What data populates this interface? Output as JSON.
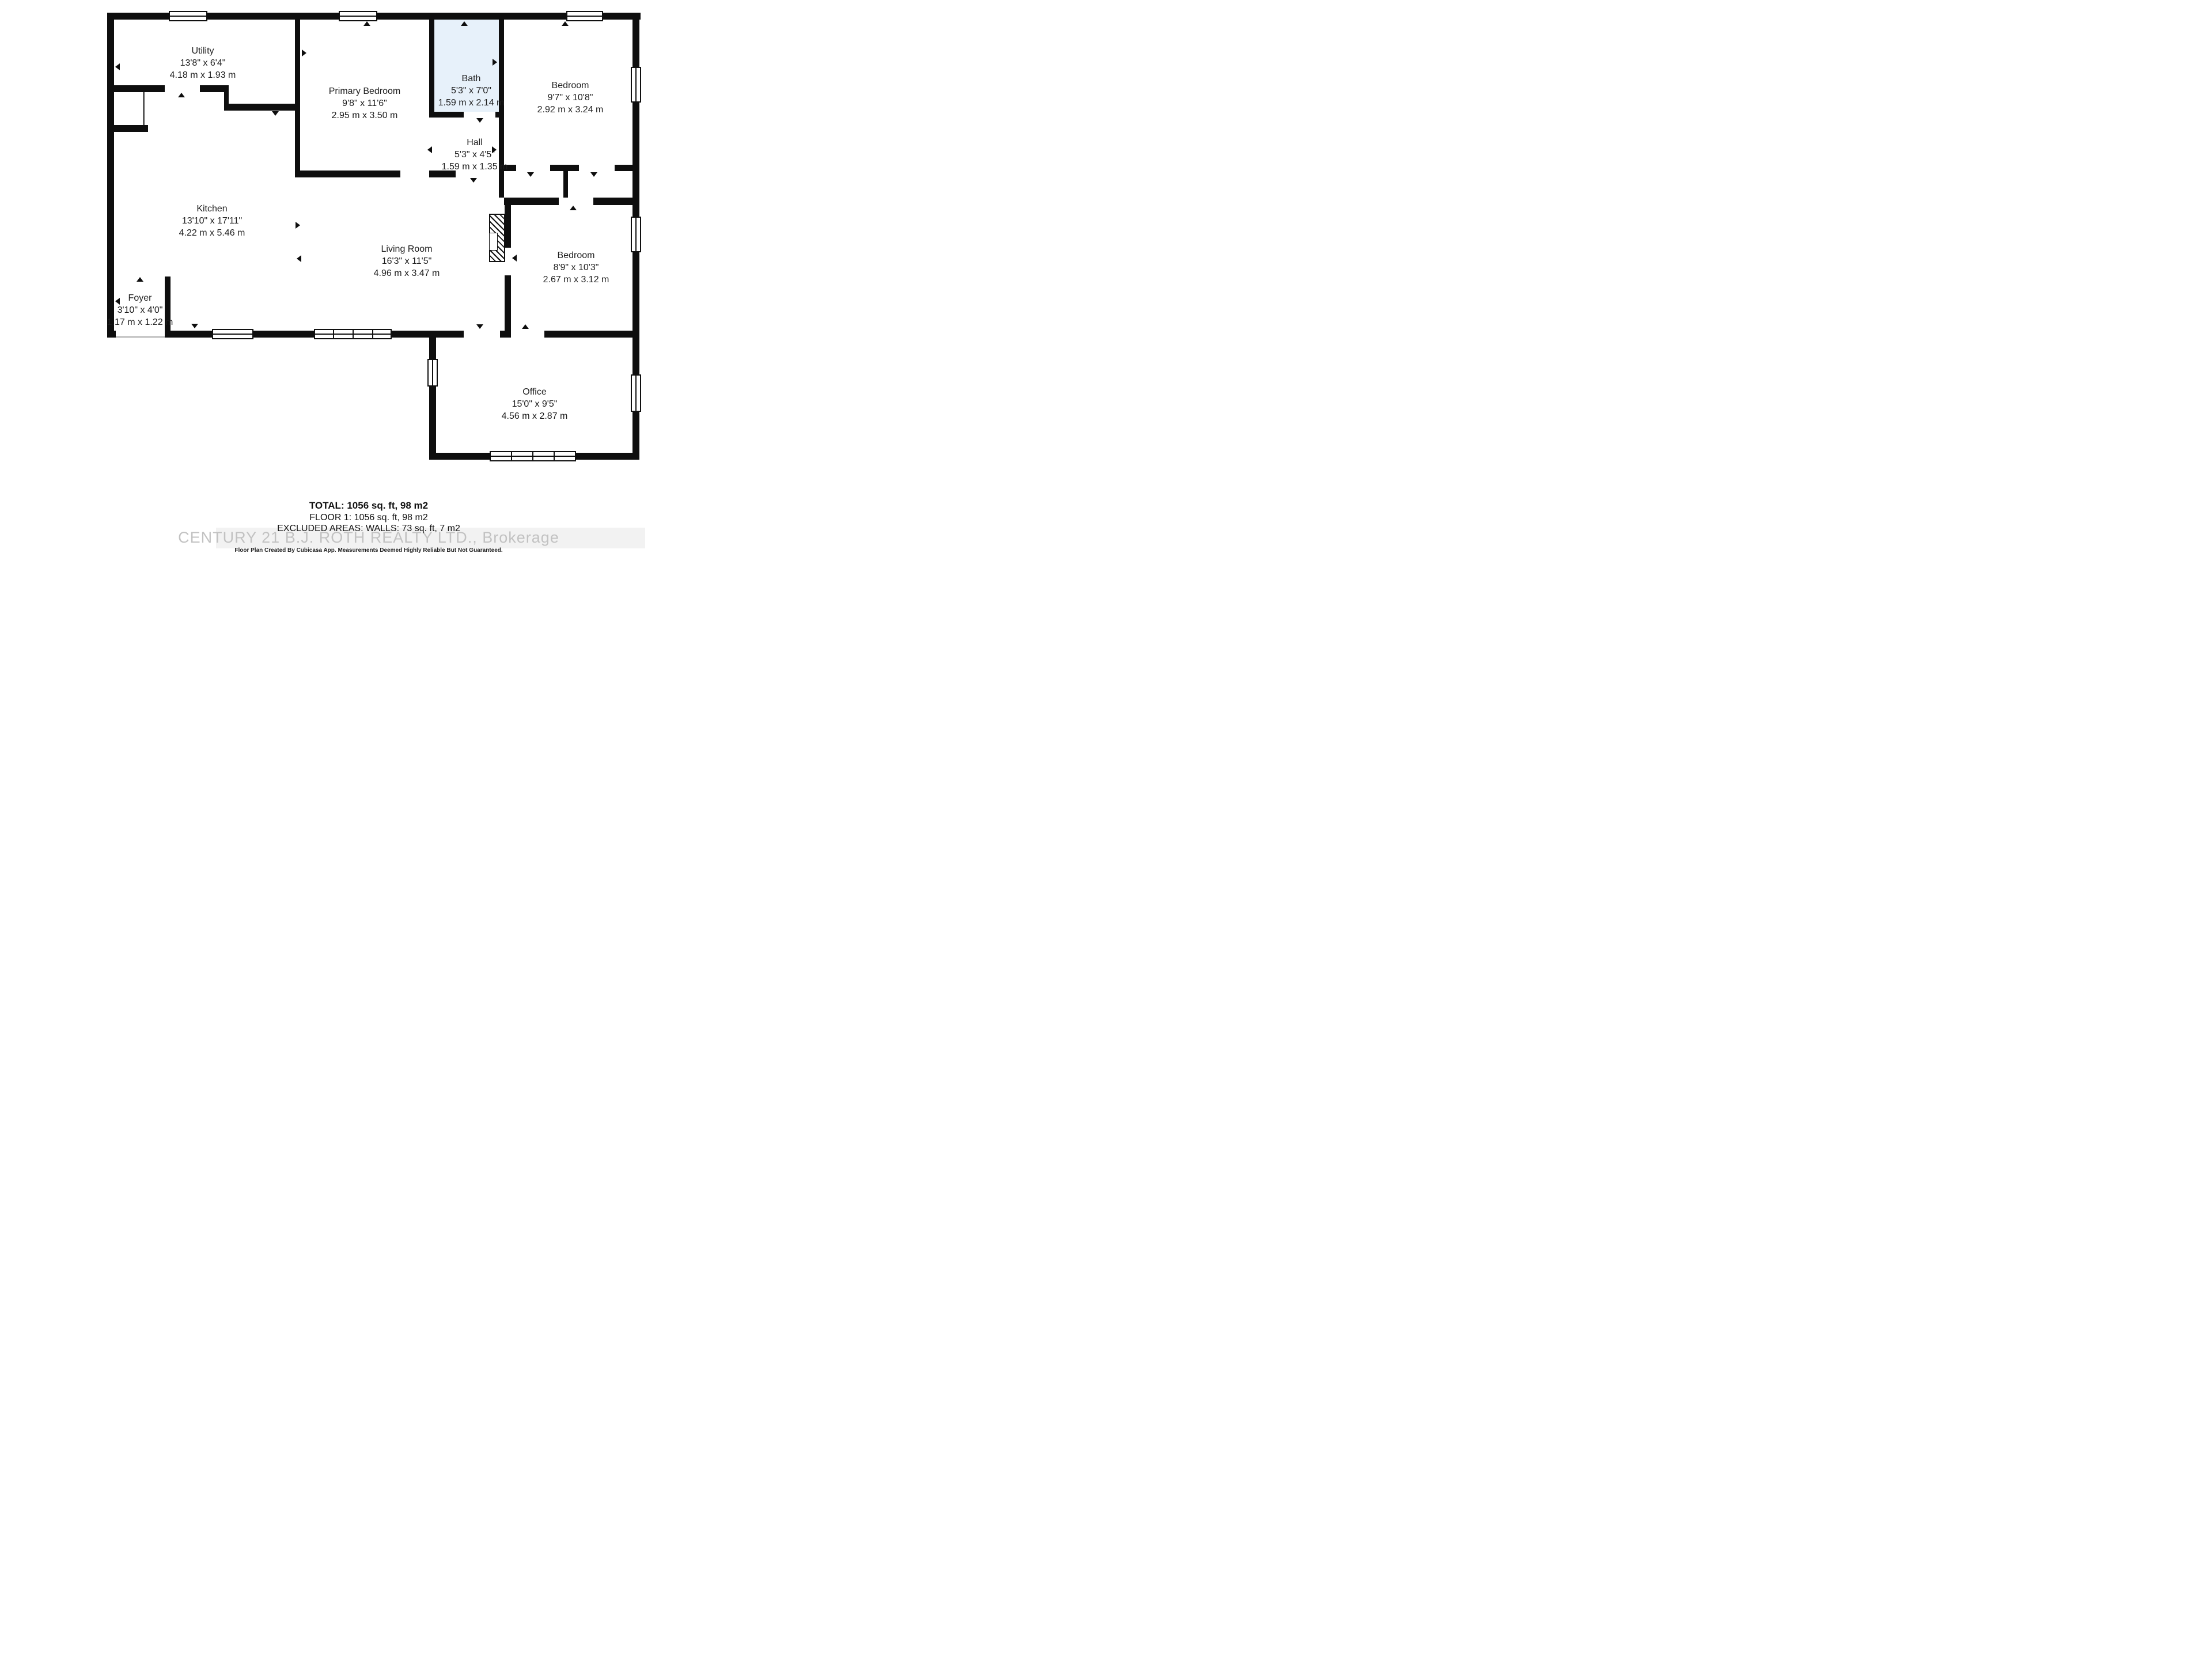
{
  "plan": {
    "type": "residential-floor-plan",
    "wall_color": "#0e0e0e",
    "bath_fill_color": "#e7f1fa",
    "watermark_color": "#c2c2c2"
  },
  "rooms": [
    {
      "name": "Utility",
      "dim_ft": "13'8\" x 6'4\"",
      "dim_m": "4.18 m x 1.93 m"
    },
    {
      "name": "Primary Bedroom",
      "dim_ft": "9'8\" x 11'6\"",
      "dim_m": "2.95 m x 3.50 m"
    },
    {
      "name": "Bath",
      "dim_ft": "5'3\" x 7'0\"",
      "dim_m": "1.59 m x 2.14 m"
    },
    {
      "name": "Bedroom",
      "dim_ft": "9'7\" x 10'8\"",
      "dim_m": "2.92 m x 3.24 m"
    },
    {
      "name": "Hall",
      "dim_ft": "5'3\" x 4'5\"",
      "dim_m": "1.59 m x 1.35 m"
    },
    {
      "name": "Kitchen",
      "dim_ft": "13'10\" x 17'11\"",
      "dim_m": "4.22 m x 5.46 m"
    },
    {
      "name": "Living Room",
      "dim_ft": "16'3\" x 11'5\"",
      "dim_m": "4.96 m x 3.47 m"
    },
    {
      "name": "Bedroom",
      "dim_ft": "8'9\" x 10'3\"",
      "dim_m": "2.67 m x 3.12 m"
    },
    {
      "name": "Foyer",
      "dim_ft": "3'10\" x 4'0\"",
      "dim_m": "1.17 m x 1.22 m"
    },
    {
      "name": "Office",
      "dim_ft": "15'0\" x 9'5\"",
      "dim_m": "4.56 m x 2.87 m"
    }
  ],
  "summary": {
    "total": "TOTAL: 1056 sq. ft, 98 m2",
    "floor1": "FLOOR 1: 1056 sq. ft, 98 m2",
    "excluded": "EXCLUDED AREAS: WALLS: 73 sq. ft, 7 m2"
  },
  "watermark": "CENTURY 21 B.J. ROTH REALTY LTD., Brokerage",
  "disclaimer": "Floor Plan Created By Cubicasa App. Measurements Deemed Highly Reliable But Not Guaranteed."
}
